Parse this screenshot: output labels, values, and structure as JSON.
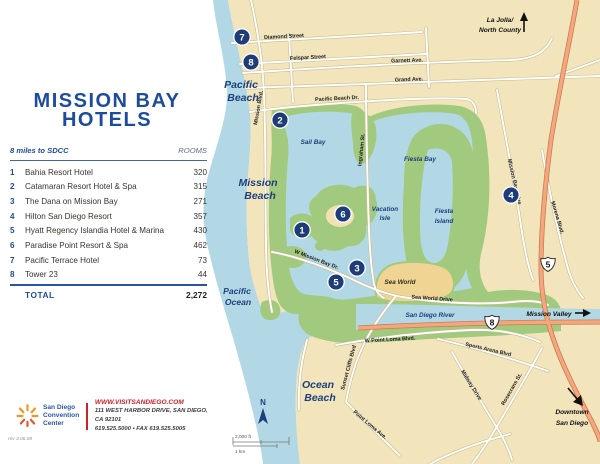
{
  "panel": {
    "title": [
      "MISSION BAY",
      "HOTELS"
    ],
    "table": {
      "distance_note": "8 miles to SDCC",
      "rooms_header": "ROOMS",
      "rows": [
        {
          "num": "1",
          "name": "Bahia Resort Hotel",
          "rooms": "320"
        },
        {
          "num": "2",
          "name": "Catamaran Resort Hotel & Spa",
          "rooms": "315"
        },
        {
          "num": "3",
          "name": "The Dana on Mission Bay",
          "rooms": "271"
        },
        {
          "num": "4",
          "name": "Hilton San Diego Resort",
          "rooms": "357"
        },
        {
          "num": "5",
          "name": "Hyatt Regency Islandia Hotel & Marina",
          "rooms": "430"
        },
        {
          "num": "6",
          "name": "Paradise Point Resort & Spa",
          "rooms": "462"
        },
        {
          "num": "7",
          "name": "Pacific Terrace Hotel",
          "rooms": "73"
        },
        {
          "num": "8",
          "name": "Tower 23",
          "rooms": "44"
        }
      ],
      "total_label": "TOTAL",
      "total_rooms": "2,272"
    },
    "logo": {
      "org": [
        "San Diego",
        "Convention",
        "Center"
      ],
      "website": "WWW.VISITSANDIEGO.COM",
      "address": "111 WEST HARBOR DRIVE, SAN DIEGO, CA 92101",
      "phone": "619.525.5000  •  FAX 619.525.5005"
    },
    "rev": "rev 3.06.08"
  },
  "map": {
    "areas": {
      "pacific_beach": [
        "Pacific",
        "Beach"
      ],
      "mission_beach": [
        "Mission",
        "Beach"
      ],
      "pacific_ocean": [
        "Pacific",
        "Ocean"
      ],
      "ocean_beach": [
        "Ocean",
        "Beach"
      ],
      "sail_bay": "Sail Bay",
      "fiesta_bay": "Fiesta Bay",
      "vacation_isle": [
        "Vacation",
        "Isle"
      ],
      "fiesta_island": [
        "Fiesta",
        "Island"
      ],
      "sea_world": "Sea World",
      "san_diego_river": "San Diego River"
    },
    "directions": {
      "la_jolla": [
        "La Jolla/",
        "North County"
      ],
      "mission_valley": "Mission Valley",
      "downtown": [
        "Downtown",
        "San Diego"
      ]
    },
    "roads": {
      "diamond": "Diamond Street",
      "felspar": "Felspar Street",
      "garnett": "Garnett Ave.",
      "grand": "Grand Ave.",
      "pacific_beach_dr": "Pacific Beach Dr.",
      "mission_blvd": "Mission Blvd.",
      "ingraham": "Ingraham St.",
      "mission_bay_drive": "Mission Bay Drive",
      "morena": "Morena Blvd.",
      "w_mission_bay_dr": "W Mission Bay Dr.",
      "sea_world_drive": "Sea World Drive",
      "w_point_loma": "W Point Loma Blvd.",
      "sunset_cliffs": "Sunset Cliffs Blvd",
      "point_loma_ave": "Point Loma Ave.",
      "sports_arena": "Sports Arena Blvd",
      "midway": "Midway Drive",
      "rosecrans": "Rosecrans St."
    },
    "markers": [
      "1",
      "2",
      "3",
      "4",
      "5",
      "6",
      "7",
      "8"
    ],
    "shields": {
      "i5": "5",
      "i8": "8"
    },
    "compass_n": "N",
    "scale_ft": "2,000 ft",
    "scale_km": "1 km"
  },
  "colors": {
    "accent_blue": "#1d4b9d",
    "marker_navy": "#1d3c78",
    "brand_red": "#cc2127",
    "land": "#f2e5bc",
    "water": "#b3d8e5",
    "park": "#a2ca7e",
    "highway": "#f3a77e"
  }
}
